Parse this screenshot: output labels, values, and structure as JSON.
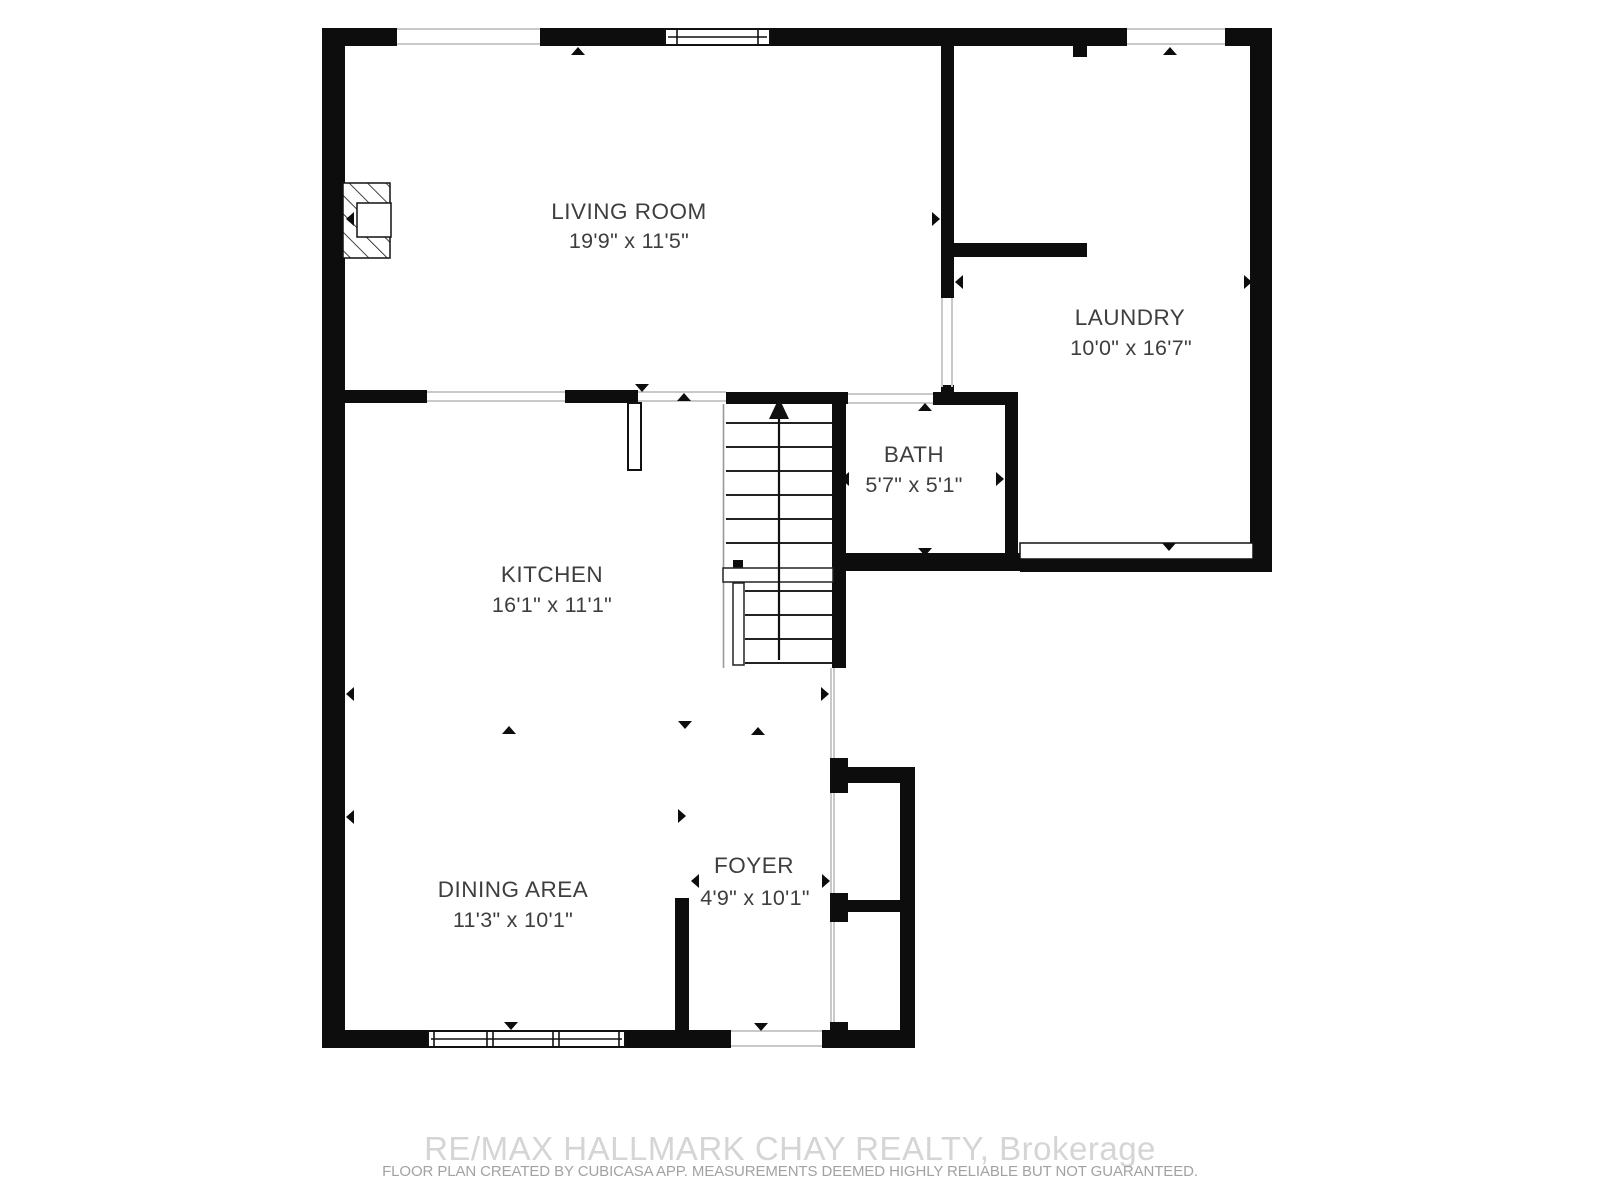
{
  "plan_title": "Main Floor Plan",
  "rooms": [
    {
      "name": "LIVING ROOM",
      "dimensions": "19'9\" x 11'5\""
    },
    {
      "name": "LAUNDRY",
      "dimensions": "10'0\" x 16'7\""
    },
    {
      "name": "BATH",
      "dimensions": "5'7\" x 5'1\""
    },
    {
      "name": "KITCHEN",
      "dimensions": "16'1\" x 11'1\""
    },
    {
      "name": "DINING AREA",
      "dimensions": "11'3\" x 10'1\""
    },
    {
      "name": "FOYER",
      "dimensions": "4'9\" x 10'1\""
    }
  ],
  "footer": {
    "brokerage": "RE/MAX HALLMARK CHAY REALTY, Brokerage",
    "disclaimer": "FLOOR PLAN CREATED BY CUBICASA APP. MEASUREMENTS DEEMED HIGHLY RELIABLE BUT NOT GUARANTEED."
  },
  "colors": {
    "wall": "#0d0d0d",
    "label": "#3e3e3e",
    "opening_line": "#c9c9c9",
    "watermark": "#d5d5d5",
    "disclaimer_text": "#a2a2a2",
    "background": "#ffffff"
  }
}
